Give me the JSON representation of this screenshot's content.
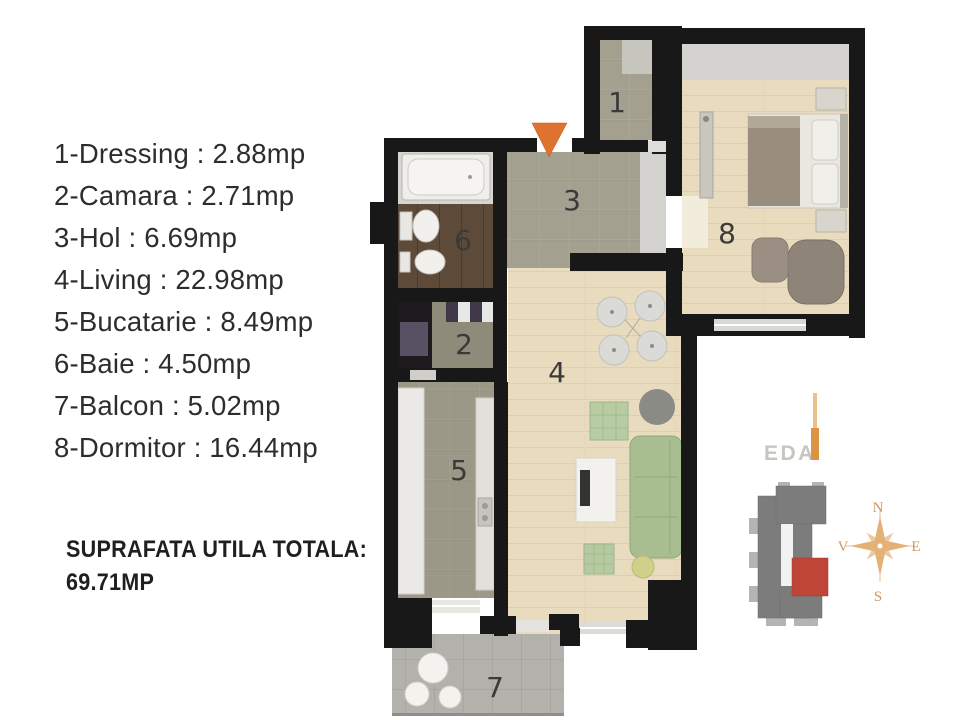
{
  "legend": {
    "items": [
      "1-Dressing : 2.88mp",
      "2-Camara : 2.71mp",
      "3-Hol : 6.69mp",
      "4-Living : 22.98mp",
      "5-Bucatarie : 8.49mp",
      "6-Baie : 4.50mp",
      "7-Balcon : 5.02mp",
      "8-Dormitor : 16.44mp"
    ],
    "total_label": "SUPRAFATA UTILA TOTALA:",
    "total_value": "69.71MP"
  },
  "plan": {
    "labels": {
      "dressing": "1",
      "camara": "2",
      "hol": "3",
      "living": "4",
      "bucatarie": "5",
      "baie": "6",
      "balcon": "7",
      "dormitor": "8"
    }
  },
  "compass": {
    "north": "N",
    "east": "E",
    "south": "S",
    "west": "V"
  },
  "logo": {
    "text": "EDA"
  },
  "colors": {
    "wall": "#181818",
    "entrance_arrow": "#dd7231",
    "unit_highlight": "#bf4636",
    "compass": "#e4b277",
    "wood_floor": "#e9dcbe",
    "tile_floor": "#a3a090",
    "balcony_floor": "#b3b1ac",
    "bath_floor": "#5e4a38"
  }
}
